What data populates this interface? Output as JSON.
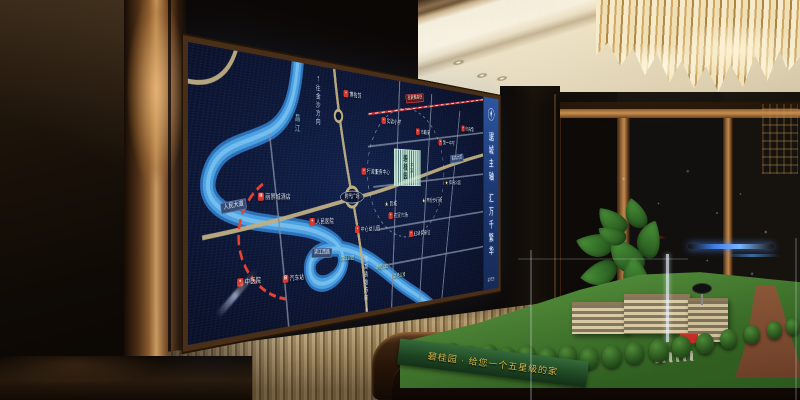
{
  "screen": {
    "banner": {
      "slogan_top": "踞城主轴",
      "slogan_bottom": "汇万千繁华",
      "brand": "碧桂园"
    },
    "map": {
      "project_name": "碧桂园",
      "project_tag": "本案",
      "plaza_label": "时代广场",
      "river_label": "昌江",
      "direction_top": "往金沙方向",
      "direction_bottom": "往高铁站方向",
      "markers": [
        {
          "type": "hospital",
          "label": "人民医院",
          "x": 198,
          "y": 186
        },
        {
          "type": "hospital",
          "label": "中医院",
          "x": 82,
          "y": 248
        },
        {
          "type": "bus",
          "label": "汽车站",
          "x": 150,
          "y": 250
        },
        {
          "type": "hotel",
          "label": "丽景城酒店",
          "x": 120,
          "y": 156
        },
        {
          "type": "pin",
          "label": "博物馆",
          "x": 255,
          "y": 28
        },
        {
          "type": "pin",
          "label": "实验小学",
          "x": 335,
          "y": 56
        },
        {
          "type": "pin",
          "label": "市政府",
          "x": 408,
          "y": 66
        },
        {
          "type": "pin",
          "label": "第一中学",
          "x": 468,
          "y": 78
        },
        {
          "type": "pin",
          "label": "体育馆",
          "x": 525,
          "y": 54
        },
        {
          "type": "pin",
          "label": "行政服务中心",
          "x": 302,
          "y": 124
        },
        {
          "type": "pin",
          "label": "农贸市场",
          "x": 350,
          "y": 182
        },
        {
          "type": "pin",
          "label": "妇幼保健院",
          "x": 400,
          "y": 208
        },
        {
          "type": "pin",
          "label": "中心幼儿园",
          "x": 285,
          "y": 198
        },
        {
          "type": "star",
          "label": "商业步行街",
          "x": 430,
          "y": 162
        },
        {
          "type": "star",
          "label": "体育公园",
          "x": 484,
          "y": 136
        },
        {
          "type": "star",
          "label": "影城",
          "x": 333,
          "y": 166
        }
      ],
      "road_labels": [
        {
          "label": "迎宾大道",
          "x": 495,
          "y": 100,
          "angle": -7,
          "rail": false
        },
        {
          "label": "滨江西路",
          "x": 198,
          "y": 224,
          "angle": 3,
          "rail": false
        },
        {
          "label": "人民大道",
          "x": 60,
          "y": 166,
          "angle": -8,
          "rail": false
        },
        {
          "label": "昌景黄高铁",
          "x": 388,
          "y": 20,
          "angle": -8,
          "rail": true
        }
      ],
      "parks": [
        {
          "label": "滨江公园",
          "x": 245,
          "y": 232
        },
        {
          "label": "市民公园",
          "x": 315,
          "y": 248
        },
        {
          "label": "湿地公园",
          "x": 352,
          "y": 262
        }
      ]
    }
  },
  "model": {
    "base_text": "碧桂园 · 给您一个五星级的家"
  },
  "colors": {
    "map_bg": "#0a122e",
    "river": "#4aa0e0",
    "accent_red": "#d8352a",
    "banner_blue": "#1d3a74",
    "gold": "#d8b84a"
  }
}
